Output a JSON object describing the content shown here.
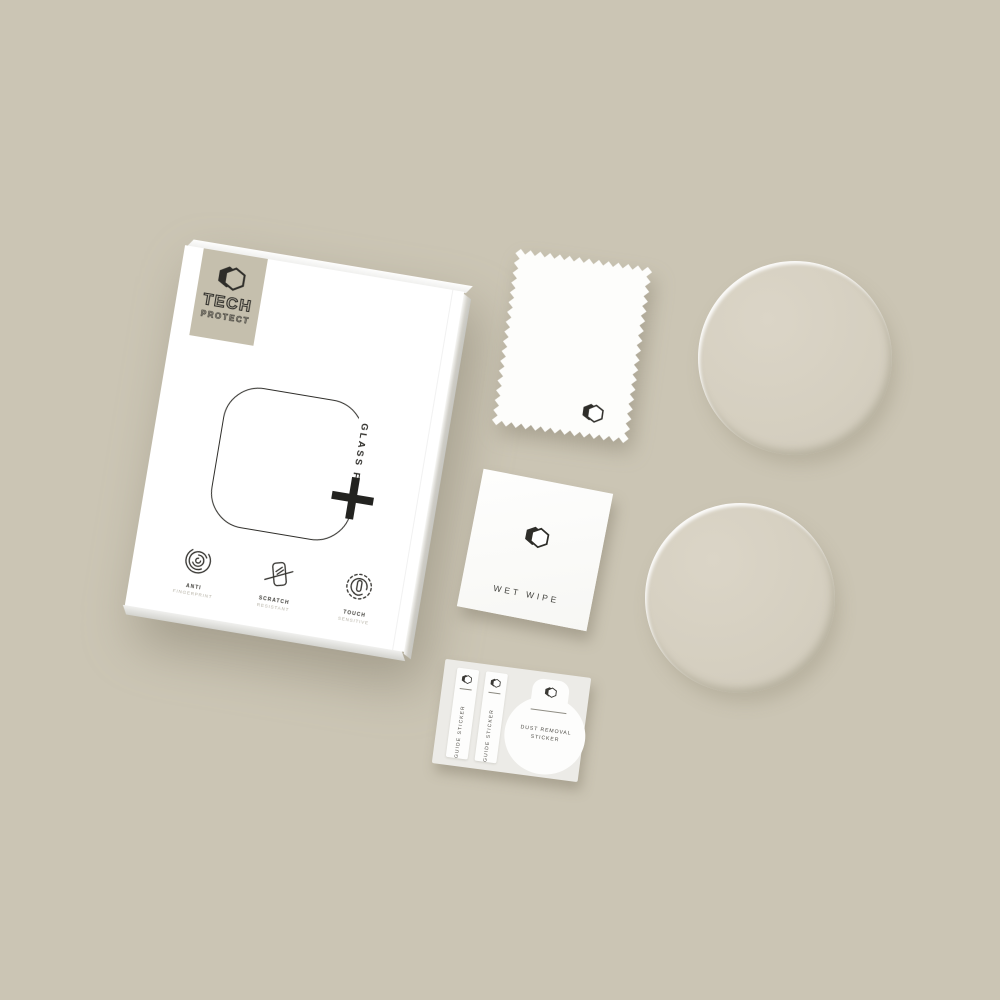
{
  "colors": {
    "background": "#cbc5b4",
    "badge": "#c5bfad",
    "ink": "#2e2d29",
    "box_face": "#ffffff",
    "glass_disc": "#d5cfc0",
    "sticker_card": "#ecebe7"
  },
  "box": {
    "brand": {
      "top": "TECH",
      "bottom": "PROTECT"
    },
    "product_line": "GLASS FIT",
    "plus_sign": "+",
    "features": [
      {
        "title": "ANTI",
        "subtitle": "FINGERPRINT",
        "icon": "fingerprint-icon"
      },
      {
        "title": "SCRATCH",
        "subtitle": "RESISTANT",
        "icon": "scratch-resistant-icon"
      },
      {
        "title": "TOUCH",
        "subtitle": "SENSITIVE",
        "icon": "touch-sensitive-icon"
      }
    ]
  },
  "accessories": {
    "microfiber_cloth": {
      "icon": "tech-protect-hexagon-icon"
    },
    "wet_wipe": {
      "label": "WET WIPE",
      "icon": "tech-protect-hexagon-icon"
    },
    "sticker_sheet": {
      "guide_stickers": [
        {
          "label": "GUIDE STICKER"
        },
        {
          "label": "GUIDE STICKER"
        }
      ],
      "dust_removal": {
        "label_line1": "DUST REMOVAL",
        "label_line2": "STICKER"
      }
    },
    "glass_discs": {
      "count": 2
    }
  }
}
